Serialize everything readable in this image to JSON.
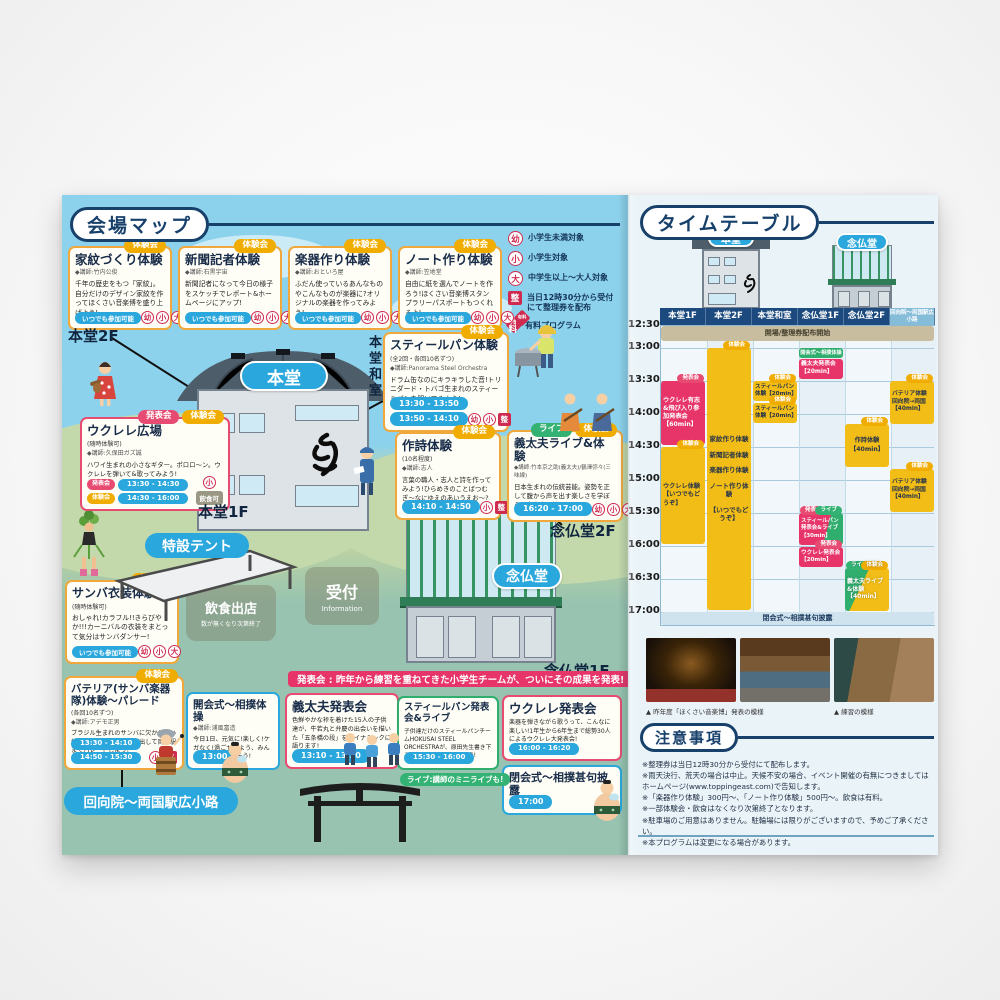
{
  "icons": {
    "yo": "幼",
    "sho": "小",
    "dai": "大",
    "sei": "整",
    "fee": "有料"
  },
  "badges": {
    "taiken": "体験会",
    "happyo": "発表会",
    "live": "ライブ"
  },
  "map": {
    "title": "会場マップ",
    "anytime": "いつでも参加可能",
    "food_ok": "飲食可",
    "banner": "発表会 : 昨年から練習を重ねてきた小学生チームが、ついにその成果を発表!",
    "live_note": "ライブ:講師のミニライブも!",
    "legend": [
      {
        "label": "小学生未満対象"
      },
      {
        "label": "小学生対象"
      },
      {
        "label": "中学生以上〜大人対象"
      },
      {
        "label": "当日12時30分から受付\nにて整理券を配布"
      },
      {
        "label": "有料プログラム"
      }
    ],
    "labels": {
      "hondo": "本堂",
      "nenbutsudo": "念仏堂",
      "hondo2f": "本堂2F",
      "hondo1f": "本堂1F",
      "hondo_washitsu": "本堂和室",
      "nenbutsudo2f": "念仏堂2F",
      "nenbutsudo1f": "念仏堂1F",
      "tokusetsu_tent": "特設テント",
      "uketsuke": "受付",
      "information": "Information",
      "inshoku": "飲食出店",
      "inshoku_note": "数が無くなり次第終了",
      "ekoin_route": "回向院〜両国駅広小路"
    },
    "cards": {
      "kamon": {
        "title": "家紋づくり体験",
        "instructor": "◆講師:竹内公俊",
        "desc": "千年の歴史をもつ「家紋」。自分だけのデザイン家紋を作ってほくさい音楽博を盛り上げよう!"
      },
      "shinbun": {
        "title": "新聞記者体験",
        "instructor": "◆講師:石黒宇宙",
        "desc": "新聞記者になって今日の様子をスケッチでレポート&ホームページにアップ!"
      },
      "gakki": {
        "title": "楽器作り体験",
        "instructor": "◆講師:おといろ屋",
        "desc": "ふだん使っているあんなものやこんなものが楽器に?オリジナルの楽器を作ってみよう!"
      },
      "notebook": {
        "title": "ノート作り体験",
        "instructor": "◆講師:笠地堂",
        "desc": "自由に紙を選んでノートを作ろう!ほくさい音楽博スタンプラリーパスポートもつくれるよ!"
      },
      "steelpan_taiken": {
        "title": "スティールパン体験",
        "sub": "(全2回・各回10名ずつ)",
        "instructor": "◆講師:Panorama Steel Orchestra",
        "desc": "ドラム缶なのにキラキラした音!トリニダード・トバゴ生まれのスティールパンを叩いてみよう!",
        "times": [
          "13:30 - 13:50",
          "13:50 - 14:10"
        ]
      },
      "ukulele_hiroba": {
        "title": "ウクレレ広場",
        "sub": "(随時体験可)",
        "instructor": "◆講師:久保田ガズ誠",
        "desc": "ハワイ生まれの小さなギター。ポロロ〜ン。ウクレレを弾いて&歌ってみよう!",
        "rows": [
          {
            "time": "13:30 - 14:30"
          },
          {
            "time": "14:30 - 16:00"
          }
        ]
      },
      "sakushi": {
        "title": "作詩体験",
        "sub": "(10名程度)",
        "instructor": "◆講師:志人",
        "desc": "言葉の職人・志人と詩を作ってみよう!ひらめきのことばつむぎ〜なにゆえのあいうえお〜?",
        "time": "14:10 - 14:50"
      },
      "gidayu_live": {
        "title": "義太夫ライブ&体験",
        "instructor": "◆講師:竹本京之助(義太夫)/鶴澤弥々(三味線)",
        "desc": "日本生まれの伝統芸能。姿勢を正して腹から声を出す楽しさを学ぼう。大声出し放題!",
        "time": "16:20 - 17:00"
      },
      "samba": {
        "title": "サンバ衣装体験",
        "sub": "(随時体験可)",
        "desc": "おしゃれ!カラフル!!きらびやか!!!カーニバルの衣装をまとって気分はサンバダンサー!"
      },
      "bateria": {
        "title": "バテリア(サンバ楽器隊)体験〜パレード",
        "sub": "(各回10名ずつ)",
        "instructor": "◆講師:アデモ正男",
        "desc": "ブラジル生まれのサンバに欠かせない打楽器隊、回向院を飛び出して両国駅までパレードしよう!",
        "times": [
          "13:30 - 14:10",
          "14:50 - 15:30"
        ]
      },
      "kaikaishiki": {
        "title": "開会式〜相撲体操",
        "instructor": "◆講師:浦風富造",
        "desc": "今日1日、元気に!楽しく!ケガなく!過ごせるよう、みんなで身体をほぐそう!",
        "time": "13:00"
      },
      "gidayu_happyo": {
        "title": "義太夫発表会",
        "desc": "色鮮やかな裃を着けた15人の子供達が、牛若丸と弁慶の出会いを描いた「五条橋の段」をダイナミックに語ります!",
        "time": "13:10 - 13:30"
      },
      "steelpan_happyo": {
        "title": "スティールパン発表会&ライブ",
        "desc": "子供達だけのスティールパンチームHOKUSAI STEEL ORCHESTRAが、原田先生書き下ろしのオリジナル曲を合奏!",
        "time": "15:30 - 16:00"
      },
      "ukulele_happyo": {
        "title": "ウクレレ発表会",
        "desc": "楽器を弾きながら歌うって、こんなに楽しい!1年生から6年生まで総勢30人によるウクレレ大発表会!",
        "time": "16:00 - 16:20"
      },
      "heikaishiki": {
        "title": "閉会式〜相撲甚句披露",
        "instructor": "◆ 浦風富造",
        "time": "17:00"
      }
    }
  },
  "timetable": {
    "title": "タイムテーブル",
    "buildings": [
      "本堂",
      "念仏堂"
    ],
    "columns": [
      "本堂1F",
      "本堂2F",
      "本堂和室",
      "念仏堂1F",
      "念仏堂2F",
      "回向院〜両国駅広小路"
    ],
    "times": [
      "12:30",
      "13:00",
      "13:30",
      "14:00",
      "14:30",
      "15:00",
      "15:30",
      "16:00",
      "16:30",
      "17:00"
    ],
    "blocks": {
      "opening": "開場/整理券配布開始",
      "hondo2f_lines": [
        "家紋作り体験",
        "新聞記者体験",
        "楽器作り体験",
        "ノート作り体験",
        "【いつでもどうぞ】"
      ],
      "ukulele_yushi": "ウクレレ有志&飛び入り参加発表会【60min】",
      "ukulele_taiken": "ウクレレ体験【いつでもどうぞ】",
      "steelpan_taiken": "スティールパン体験【20min】",
      "kaikaishiki": "開会式〜相撲体操",
      "gidayu_happyo": "義太夫発表会【20min】",
      "sakushi": "作詩体験【40min】",
      "bateria": "バテリア体験 回向院→両国【40min】",
      "steelpan_happyo": "スティールパン発表会&ライブ【30min】",
      "ukulele_happyo": "ウクレレ発表会【20min】",
      "gidayu_live": "義太夫ライブ&体験【40min】",
      "closing": "閉会式〜相撲甚句披露"
    }
  },
  "photos": {
    "caption_left": "▲ 昨年度「ほくさい音楽博」発表の模様",
    "caption_right": "▲ 練習の模様"
  },
  "notes": {
    "title": "注意事項",
    "items": [
      "※整理券は当日12時30分から受付にて配布します。",
      "※雨天決行、荒天の場合は中止。天候不安の場合、イベント開催の有無につきましてはホームページ(www.toppingeast.com)で告知します。",
      "※「楽器作り体験」300円〜、「ノート作り体験」500円〜。飲食は有料。",
      "※一部体験会・飲食はなくなり次第終了となります。",
      "※駐車場のご用意はありません。駐輪場には限りがございますので、予めご了承ください。",
      "※本プログラムは変更になる場合があります。"
    ]
  }
}
